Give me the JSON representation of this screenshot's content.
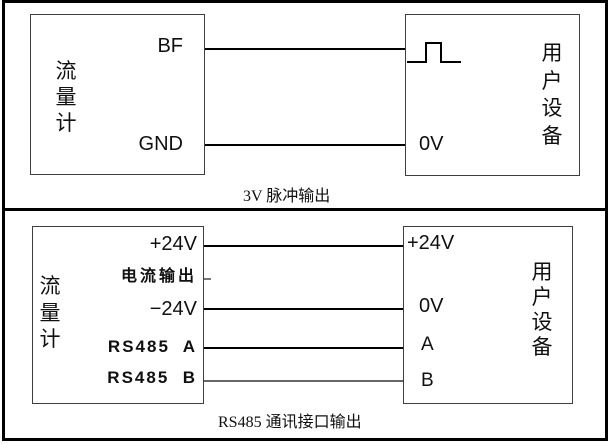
{
  "colors": {
    "frame": "#000000",
    "box_border": "#3f3f3f",
    "wire": "#000000",
    "background": "#ffffff",
    "text": "#101010"
  },
  "panels": [
    {
      "caption": "3V 脉冲输出",
      "flowmeter": {
        "label": "流\n量\n计",
        "terminals": [
          "BF",
          "GND"
        ]
      },
      "device": {
        "label": "用\n户\n设\n备",
        "terminals": [
          "0V"
        ],
        "icon": "pulse-waveform"
      }
    },
    {
      "caption": "RS485 通讯接口输出",
      "flowmeter": {
        "label": "流\n量\n计",
        "terminals": [
          "+24V",
          "电流输出",
          "−24V",
          "RS485  A",
          "RS485  B"
        ]
      },
      "device": {
        "label": "用\n户\n设\n备",
        "terminals": [
          "+24V",
          "0V",
          "A",
          "B"
        ]
      }
    }
  ]
}
